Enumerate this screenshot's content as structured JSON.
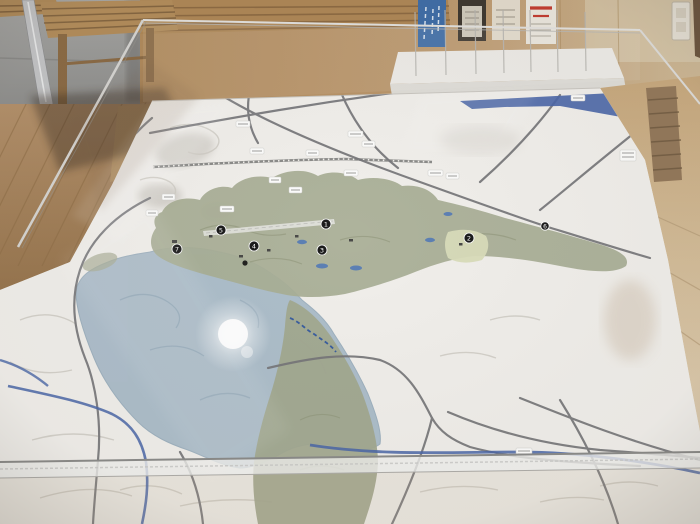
{
  "markers": [
    {
      "number": "1"
    },
    {
      "number": "2"
    },
    {
      "number": "3"
    },
    {
      "number": "4"
    },
    {
      "number": "5"
    },
    {
      "number": "6"
    },
    {
      "number": "7"
    }
  ],
  "palette": {
    "terrain": "#f1efeb",
    "lake_zone": "#a4b8c6",
    "urban_zone": "#a9ae96",
    "urban_zone_lower": "#a3a88f",
    "highlight_patch": "#d9dcba",
    "river_blue": "#4a66a8",
    "road_gray": "#77777a",
    "marker_black": "#1c1c1c",
    "wood_wall": "#b8946a",
    "concrete_wall": "#9c9c9a",
    "floor_wood": "#a8854f",
    "pamphlet_blue": "#3f6da6",
    "pamphlet_red": "#c23b30",
    "acrylic_edge": "#d8d7d4"
  }
}
